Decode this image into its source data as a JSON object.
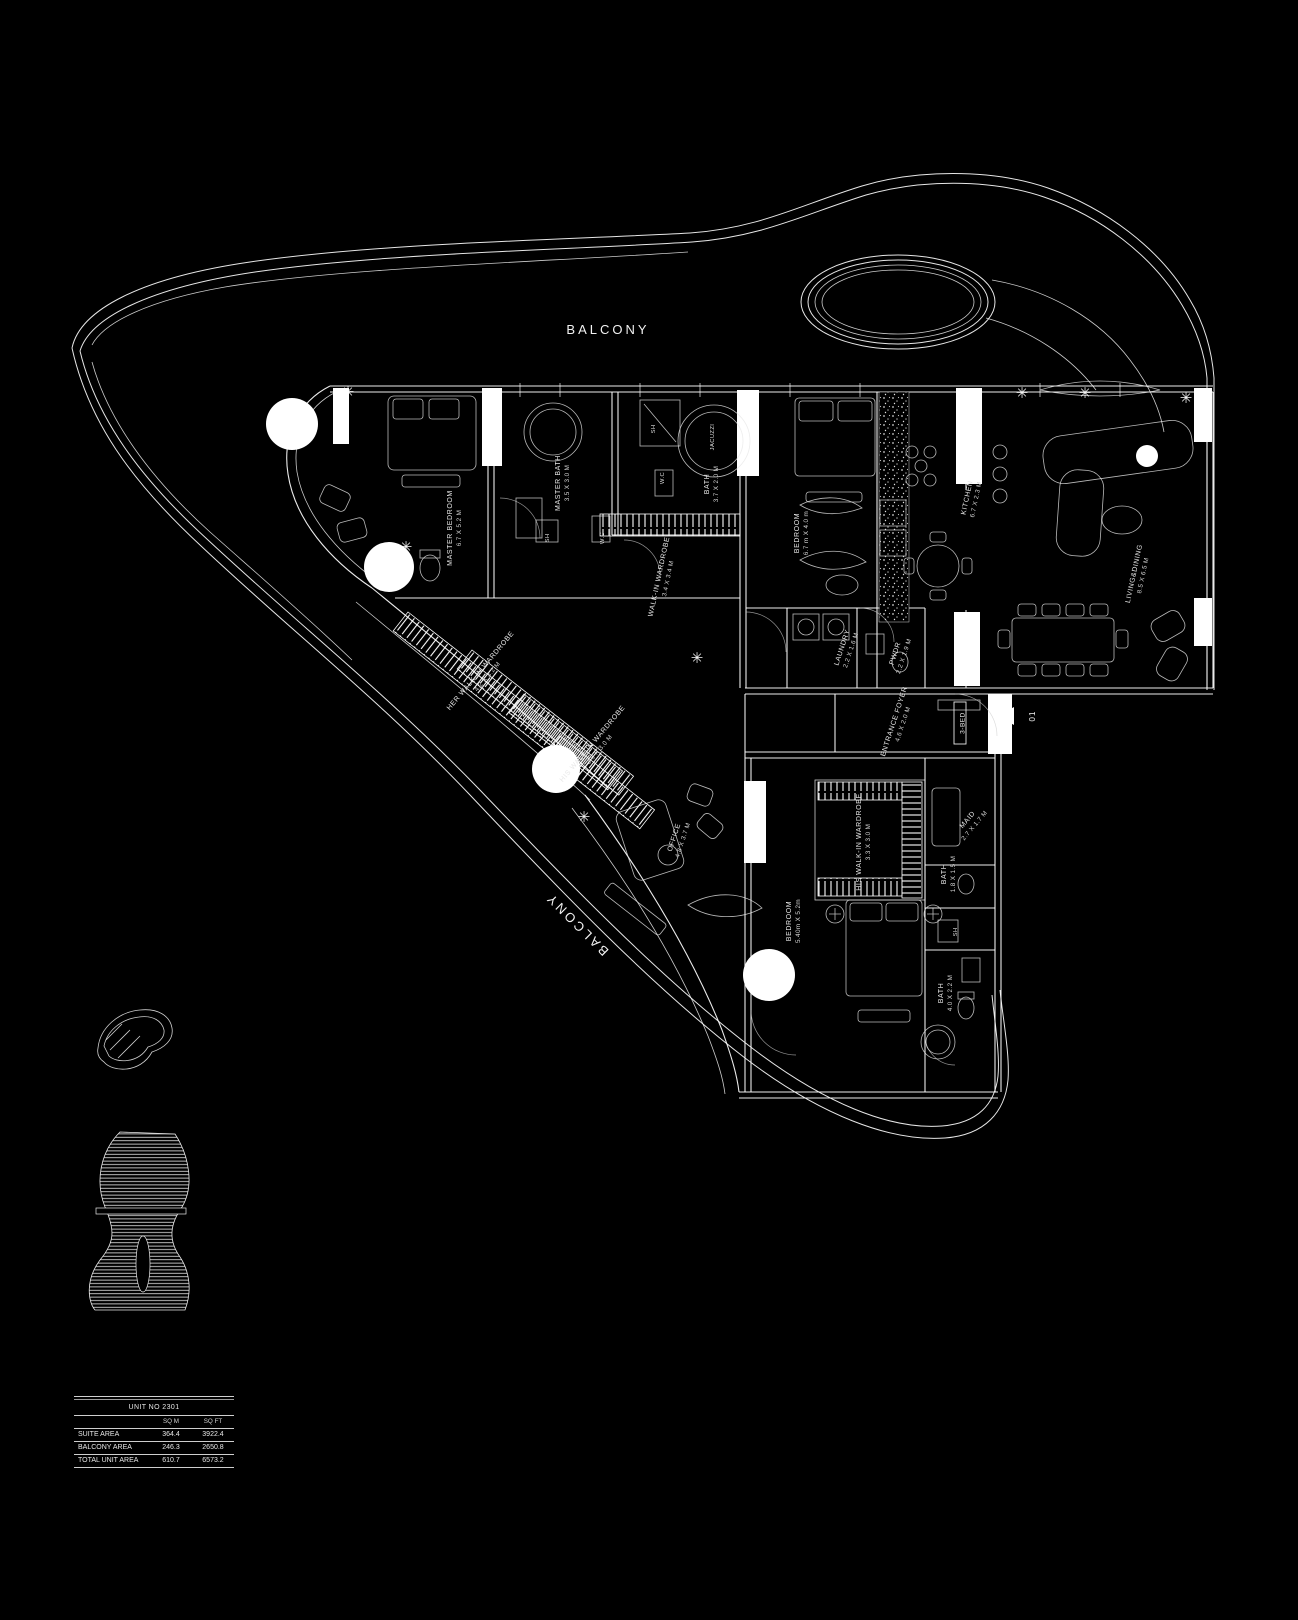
{
  "balcony": {
    "top": "BALCONY",
    "side": "BALCONY"
  },
  "unit_marker": {
    "number": "01",
    "type": "3-BED"
  },
  "rooms": [
    {
      "label": "MASTER BEDROOM",
      "dims": "6.7 X 5.2 M"
    },
    {
      "label": "MASTER BATH",
      "dims": "3.5 X 3.0 M"
    },
    {
      "label": "SH",
      "dims": ""
    },
    {
      "label": "W.C",
      "dims": ""
    },
    {
      "label": "SH",
      "dims": ""
    },
    {
      "label": "JACUZZI",
      "dims": ""
    },
    {
      "label": "W.C",
      "dims": ""
    },
    {
      "label": "BATH",
      "dims": "3.7 X 2.0 M"
    },
    {
      "label": "WALK-IN WARDROBE",
      "dims": "3.4 X 3.4 M"
    },
    {
      "label": "BEDROOM",
      "dims": "6.7 m X 4.0 m"
    },
    {
      "label": "KITCHEN",
      "dims": "6.7 X 2.3 M"
    },
    {
      "label": "LIVING&DINING",
      "dims": "8.5 X 6.5 M"
    },
    {
      "label": "LAUNDRY",
      "dims": "2.2 X 1.6 M"
    },
    {
      "label": "PWDR",
      "dims": "2.2 X 1.9 M"
    },
    {
      "label": "ENTRANCE FOYER",
      "dims": "4.6 X 2.0 M"
    },
    {
      "label": "HER WALK-IN WARDROBE",
      "dims": "4.2 X 3.2 M"
    },
    {
      "label": "HIS WALK-IN WARDROBE",
      "dims": "3.6 X 3.0 M"
    },
    {
      "label": "OFFICE",
      "dims": "4.8 X 3.7 M"
    },
    {
      "label": "HIS WALK-IN WARDROBE",
      "dims": "3.3 X 3.0 M"
    },
    {
      "label": "MAID",
      "dims": "2.7 X 1.7 M"
    },
    {
      "label": "BATH",
      "dims": "1.8 X 1.5 M"
    },
    {
      "label": "BEDROOM",
      "dims": "5.40m X 5.2m"
    },
    {
      "label": "SH",
      "dims": ""
    },
    {
      "label": "BATH",
      "dims": "4.0 X 2.2 M"
    }
  ],
  "area_table": {
    "title": "UNIT NO 2301",
    "columns": [
      "SQ M",
      "SQ FT"
    ],
    "rows": [
      {
        "label": "SUITE AREA",
        "sqm": "364.4",
        "sqft": "3922.4"
      },
      {
        "label": "BALCONY AREA",
        "sqm": "246.3",
        "sqft": "2650.8"
      },
      {
        "label": "TOTAL UNIT AREA",
        "sqm": "610.7",
        "sqft": "6573.2"
      }
    ]
  }
}
